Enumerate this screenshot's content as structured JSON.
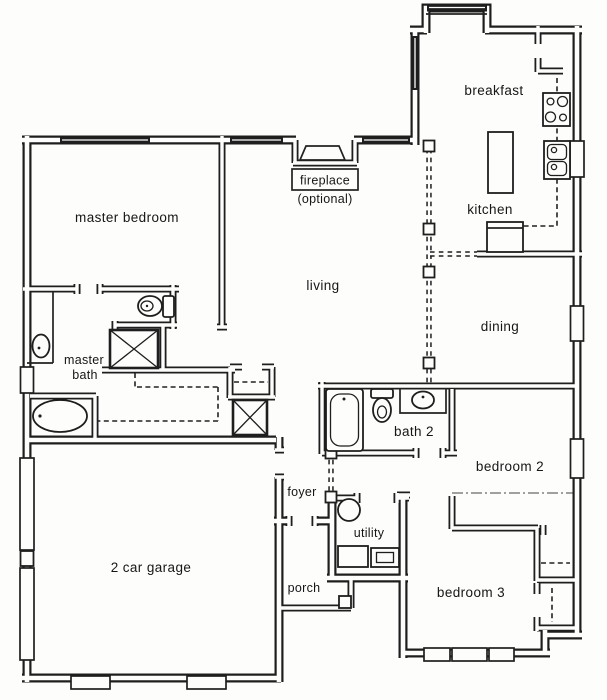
{
  "plan": {
    "type": "single-story house floor plan",
    "colors": {
      "line": "#1e1e1e",
      "background": "#fdfdfc"
    },
    "labels": {
      "master_bedroom": "master bedroom",
      "living": "living",
      "breakfast": "breakfast",
      "kitchen": "kitchen",
      "dining": "dining",
      "master_bath_line1": "master",
      "master_bath_line2": "bath",
      "fireplace": "fireplace",
      "fireplace_note": "(optional)",
      "garage": "2 car garage",
      "foyer": "foyer",
      "porch": "porch",
      "utility": "utility",
      "bath2": "bath 2",
      "bedroom2": "bedroom 2",
      "bedroom3": "bedroom 3"
    },
    "fixtures": {
      "master_bath": [
        "toilet",
        "shower",
        "bathtub",
        "sink",
        "linen-cabinet",
        "closet-rod-dashed"
      ],
      "bath2": [
        "bathtub",
        "toilet",
        "sink-counter"
      ],
      "kitchen": [
        "cooktop",
        "double-sink",
        "island",
        "bar-counter",
        "counter-dashed"
      ],
      "utility": [
        "water-heater",
        "washer",
        "dryer"
      ],
      "living": [
        "fireplace-optional"
      ],
      "structure": [
        "column-posts",
        "bay-window",
        "garage-doors",
        "windows"
      ]
    }
  }
}
